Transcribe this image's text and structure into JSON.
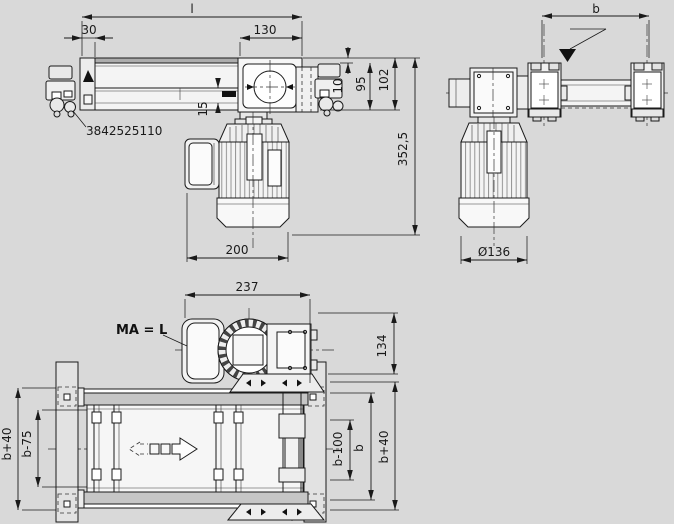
{
  "part_number": "3842525110",
  "plan_label": "MA = L",
  "dims": {
    "length": "l",
    "offset30": "30",
    "head130": "130",
    "width_b": "b",
    "belt10": "10",
    "profile95": "95",
    "total102": "102",
    "clamp15": "15",
    "height352": "352,5",
    "motor200": "200",
    "motor_dia": "Ø136",
    "drive237": "237",
    "overhang134": "134",
    "left_outer": "b+40",
    "left_inner": "b-75",
    "right_inner": "b-100",
    "right_b": "b",
    "right_outer": "b+40"
  },
  "colors": {
    "background": "#d9d9d9",
    "line": "#1a1a1a",
    "body_fill": "#f4f4f4",
    "profile_gray": "#c6c6c6",
    "belt_gray": "#adadad",
    "marker_black": "#111111"
  }
}
